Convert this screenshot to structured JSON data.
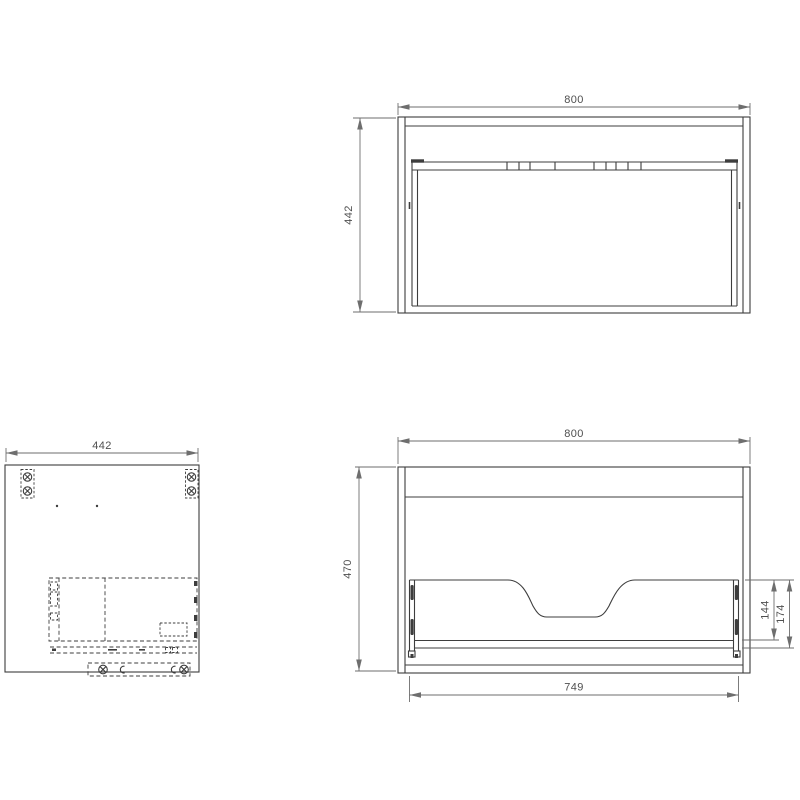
{
  "views": {
    "top": {
      "label": "top-view",
      "dim_width": "800",
      "dim_depth": "442"
    },
    "side": {
      "label": "side-panel-view",
      "dim_width": "442"
    },
    "front": {
      "label": "front-view",
      "dim_width": "800",
      "dim_height": "470",
      "dim_drawer_width": "749",
      "dim_cutout_to_bottom": "144",
      "dim_back_to_base": "174"
    }
  },
  "colors": {
    "background": "#ffffff",
    "object_line": "#3d3d3d",
    "dimension_line": "#6e6e6e",
    "text": "#4f4f4f"
  }
}
